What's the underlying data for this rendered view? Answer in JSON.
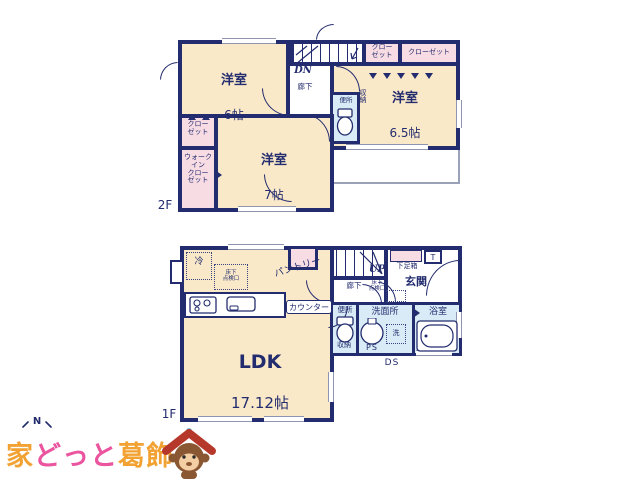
{
  "palette": {
    "wall_navy": "#232C6E",
    "room_cream": "#F9E9C9",
    "closet_pink": "#F8DCE4",
    "wet_area_blue": "#D9EBF6"
  },
  "floor2": {
    "label": "2F",
    "bedroom6": {
      "name": "洋室",
      "size": "6帖"
    },
    "bedroom65": {
      "name": "洋室",
      "size": "6.5帖"
    },
    "bedroom7": {
      "name": "洋室",
      "size": "7帖"
    },
    "closet_top1": "クロー\nゼット",
    "closet_top2": "クローゼット",
    "closet_left": "クロー\nゼット",
    "wic": "ウォーク\nイン\nクロー\nゼット",
    "hallway": "廊下",
    "stairs": "DN",
    "toilet": "便所",
    "storage": "収\n納"
  },
  "floor1": {
    "label": "1F",
    "ldk": {
      "name": "LDK",
      "size": "17.12帖"
    },
    "fridge": "冷",
    "underfloor_hatch_kitchen": "床下\n点検口",
    "pantry": "パントリー",
    "counter": "カウンター",
    "stairs": "UP",
    "hallway": "廊下",
    "underfloor_hatch_hall": "床下\n点検口",
    "shoe_box": "下足箱",
    "t_box": "T",
    "entrance": "玄関",
    "toilet": "便所",
    "toilet_storage": "収納",
    "washroom": "洗面所",
    "pipe_space": "PS",
    "washer": "洗",
    "bathroom": "浴室",
    "duct_space": "DS"
  },
  "watermark": {
    "north": "N",
    "brand": {
      "part1": "家",
      "part2": "どっと",
      "part3": "葛飾"
    },
    "colors": {
      "orange": "#F2A233",
      "pink": "#EB549E"
    }
  }
}
